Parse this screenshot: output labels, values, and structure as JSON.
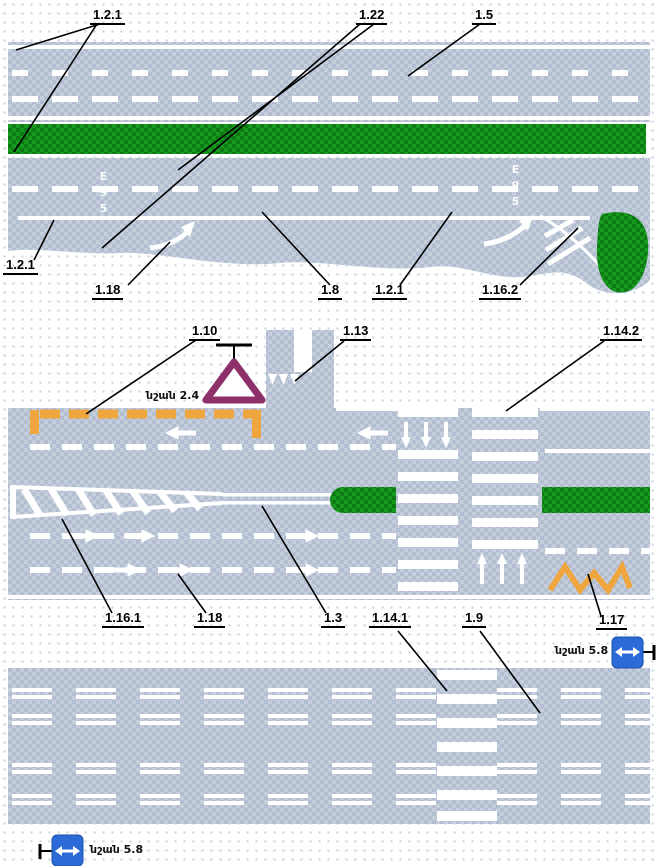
{
  "callouts": {
    "c121top": "1.2.1",
    "c122": "1.22",
    "c15": "1.5",
    "c121left": "1.2.1",
    "c118top": "1.18",
    "c18": "1.8",
    "c121mid": "1.2.1",
    "c1162": "1.16.2",
    "c110": "1.10",
    "c113": "1.13",
    "c1142": "1.14.2",
    "c1161": "1.16.1",
    "c118bot": "1.18",
    "c13": "1.3",
    "c1141": "1.14.1",
    "c19": "1.9",
    "c117": "1.17"
  },
  "signs": {
    "yield_sign_caption": "նշան 2.4",
    "reversible_sign_right_caption": "նշան 5.8",
    "reversible_sign_bottom_caption": "նշան 5.8"
  },
  "road_texts": {
    "left": "Е95",
    "right": "Е95"
  },
  "colors": {
    "asphalt": "#b3bfd0",
    "asphalt_check": "#c4cedc",
    "green": "#169a1e",
    "green_dark": "#0d7a14",
    "orange": "#efa63e",
    "sign_purple": "#8e3069",
    "sign_blue": "#2a6bd8",
    "marking_white": "#ffffff"
  }
}
